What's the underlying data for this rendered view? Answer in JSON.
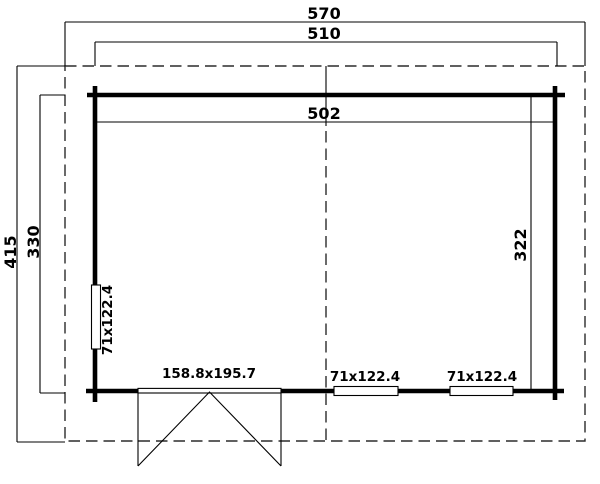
{
  "plan": {
    "title": "garden-house-floor-plan",
    "dimensions": {
      "roof_width": "570",
      "exterior_width": "510",
      "interior_width": "502",
      "roof_depth": "415",
      "exterior_depth": "330",
      "interior_depth": "322"
    },
    "openings": {
      "left_window": "71x122.4",
      "double_door": "158.8x195.7",
      "front_window_1": "71x122.4",
      "front_window_2": "71x122.4"
    },
    "colors": {
      "line": "#000000",
      "dashed_line": "#2b2b2b",
      "background": "#ffffff"
    }
  }
}
